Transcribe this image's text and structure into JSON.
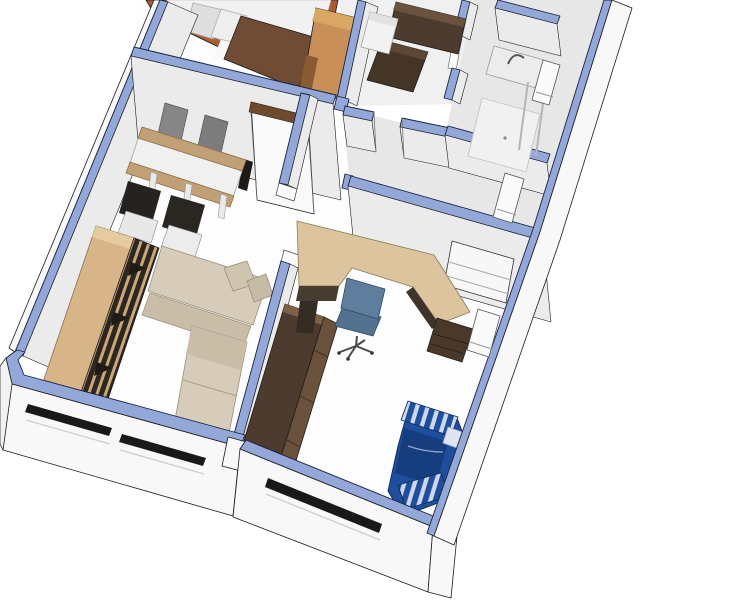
{
  "scene": {
    "type": "3d-floorplan-cutaway-render",
    "rooms": [
      "bedroom",
      "kitchen",
      "bathroom",
      "hallway",
      "living-room",
      "office"
    ],
    "furniture": [
      "double-bed",
      "wardrobe",
      "kitchen-counter",
      "fridge",
      "bath-vanity",
      "shower",
      "dining-table",
      "dining-chairs",
      "bookshelf",
      "corner-sofa",
      "corner-desk",
      "office-chair",
      "sideboard",
      "striped-daybed"
    ]
  },
  "colors": {
    "background": "#ffffff",
    "wall_top": "#93a8d8",
    "wall_top_edge": "#18233f",
    "outline": "#1c1c1c",
    "wall_face": "#ebebeb",
    "wall_outer": "#f8f8f8",
    "floor_white": "#fdfdfd",
    "floor_light": "#f0f0f0",
    "floor_gray": "#e7e7e7",
    "wood_light": "#d8b588",
    "wood_mid": "#c89058",
    "wood_desk": "#dcc59e",
    "wood_trim": "#c2a076",
    "wood_bed": "#aa5c34",
    "wood_dark": "#4c3b2e",
    "wood_front": "#6a523d",
    "blanket": "#6f4c33",
    "bedding": "#f1f1f1",
    "pillow": "#dedede",
    "sofa": "#d7ccba",
    "sofa_dark": "#c9bda8",
    "chair_gray": "#868686",
    "chair_seat": "#d6d6d6",
    "chair_dark": "#262220",
    "office_chair": "#5f7d9c",
    "office_chair_dark": "#54718f",
    "daybed_blue": "#1e4e9c",
    "daybed_dark": "#163e7e",
    "daybed_stripe": "#cfd8ea",
    "glass": "#b5b5b5",
    "window_slit": "#191919"
  }
}
